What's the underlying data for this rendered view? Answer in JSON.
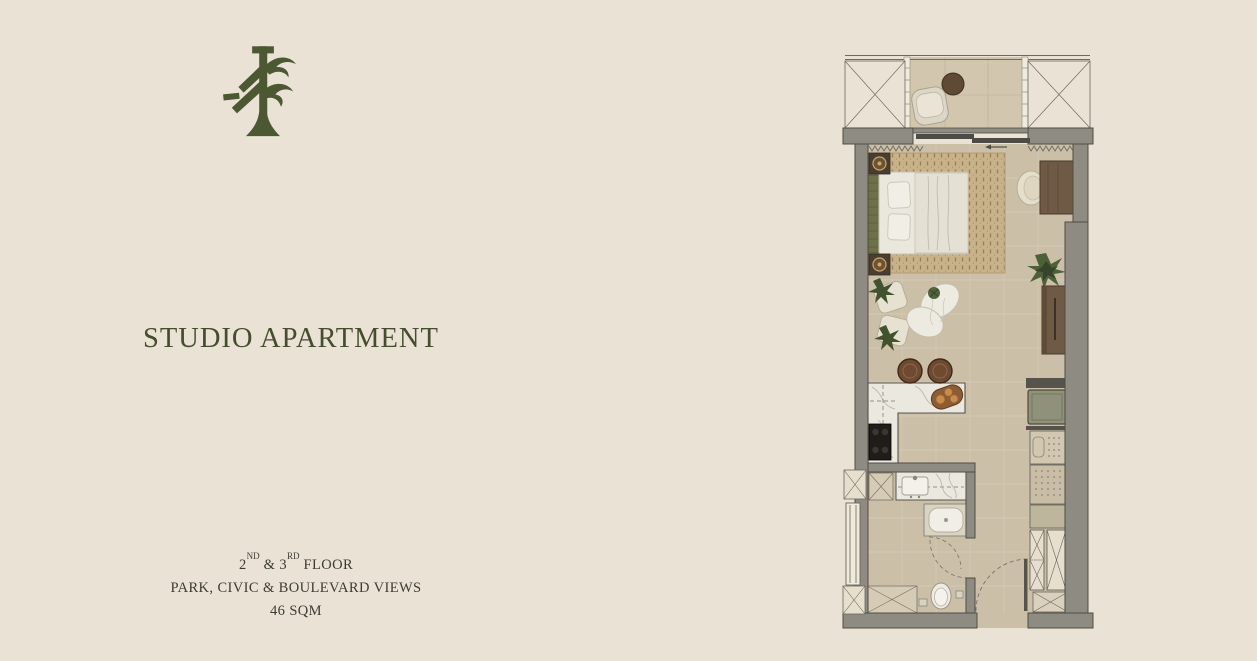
{
  "page": {
    "background_color": "#eae3d5",
    "accent_green": "#4b5831",
    "title_color": "#454d2e",
    "body_text_color": "#3c3b32"
  },
  "brand": {
    "logo_icon": "tree-logo"
  },
  "listing": {
    "title": "STUDIO APARTMENT",
    "details": {
      "floors_prefix": "2",
      "floors_sup1": "ND",
      "floors_mid": " & 3",
      "floors_sup2": "RD",
      "floors_suffix": " FLOOR",
      "views": "PARK, CIVIC & BOULEVARD VIEWS",
      "area": "46 SQM"
    }
  },
  "floor_plan": {
    "label": "studio-apartment-floor-plan",
    "colors": {
      "floor": "#cbbfa8",
      "balcony_floor": "#d3c6af",
      "walls": "#8e8b82",
      "wall_outline": "#4f4c44",
      "rug": "#c8b28a",
      "wood": "#6f5a45",
      "marble": "#ebe8df",
      "plant_green": "#4d6038",
      "appliance_green": "#90917a"
    },
    "elements": [
      "balcony-with-chair-and-table",
      "service-shaft-hatched-left",
      "service-shaft-hatched-right",
      "sliding-balcony-door",
      "double-bed-with-nightstands",
      "area-rug",
      "desk-with-chair",
      "potted-plant",
      "tall-cabinet",
      "lounge-chairs-with-plants",
      "organic-lounge-seat",
      "kitchen-island-with-stools",
      "cooktop",
      "refrigerator",
      "pantry-cabinets",
      "wardrobe",
      "bathroom-vanity",
      "shower",
      "toilet",
      "entry-door-swing",
      "duct-shafts"
    ]
  }
}
